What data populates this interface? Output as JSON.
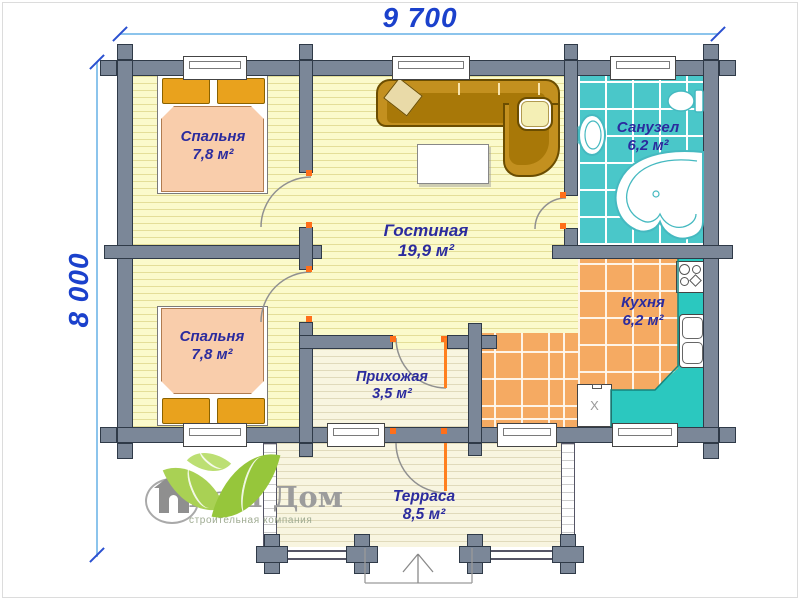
{
  "dimensions": {
    "width_label": "9 700",
    "height_label": "8 000"
  },
  "rooms": {
    "bedroom1": {
      "name": "Спальня",
      "area": "7,8 м²"
    },
    "bedroom2": {
      "name": "Спальня",
      "area": "7,8 м²"
    },
    "living": {
      "name": "Гостиная",
      "area": "19,9 м²"
    },
    "bathroom": {
      "name": "Санузел",
      "area": "6,2 м²"
    },
    "kitchen": {
      "name": "Кухня",
      "area": "6,2 м²"
    },
    "hallway": {
      "name": "Прихожая",
      "area": "3,5 м²"
    },
    "terrace": {
      "name": "Терраса",
      "area": "8,5 м²"
    }
  },
  "appliances": {
    "fridge_label": "X"
  },
  "logo": {
    "title": "Ваш Дом",
    "tagline": "строительная компания"
  },
  "colors": {
    "wall": "#7B8798",
    "wall_outline": "#2F3A48",
    "floor_yellow": "#FBFACB",
    "floor_cream": "#F8F5E0",
    "bathroom_tile": "#4AC7C9",
    "kitchen_tile": "#F5AA62",
    "counter": "#2BC8BF",
    "dimension_blue": "#1B41CC",
    "label_navy": "#2B2B9E",
    "door_marker": "#FF6F1A",
    "logo_green": "#96C63B",
    "bed_pillow": "#E9A21D",
    "bed_blanket": "#F9CDAB",
    "sofa_gold": "#C3901F"
  }
}
